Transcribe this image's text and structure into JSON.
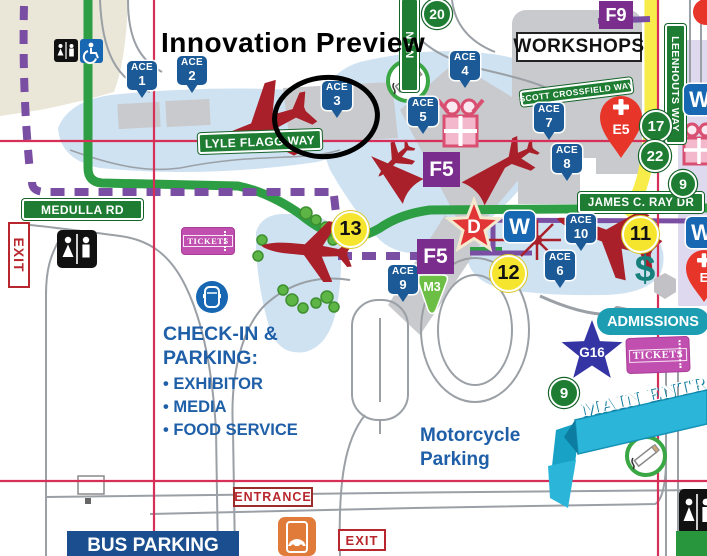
{
  "title": "Innovation Preview",
  "roads": {
    "lyle_flagg": "LYLE FLAGG WAY",
    "medulla": "MEDULLA RD",
    "james_ray": "JAMES C. RAY DR",
    "scott_crossfield": "SCOTT CROSSFIELD WAY",
    "leenhouts": "LEENHOUTS WAY",
    "partial_lane": "N LN"
  },
  "buildings": {
    "workshops": "WORKSHOPS"
  },
  "ace": {
    "label": "ACE",
    "numbers": [
      "1",
      "2",
      "3",
      "4",
      "5",
      "6",
      "7",
      "8",
      "9",
      "10"
    ]
  },
  "zones": {
    "f5": "F5",
    "f9": "F9",
    "m3": "M3",
    "g16": "G16",
    "d_star": "D",
    "e5": "E5",
    "e_partial": "E",
    "water": "W"
  },
  "circle_markers": {
    "n20": "20",
    "n17": "17",
    "n22": "22",
    "n9": "9",
    "y13": "13",
    "y11": "11",
    "y12": "12"
  },
  "signs": {
    "exit": "EXIT",
    "entrance": "ENTRANCE",
    "tickets": "TICKETS",
    "admissions": "ADMISSIONS",
    "main_entrance": "MAIN ENTR",
    "bus_parking": "BUS PARKING"
  },
  "texts": {
    "checkin_line1": "CHECK-IN &",
    "checkin_line2": "PARKING:",
    "checkin_items": [
      "• EXHIBITOR",
      "• MEDIA",
      "• FOOD SERVICE"
    ],
    "motorcycle_line1": "Motorcycle",
    "motorcycle_line2": "Parking",
    "dollar": "$"
  },
  "colors": {
    "grid": "#d63058",
    "route_green": "#2e9e44",
    "route_purple": "#7a4fa3",
    "ace_blue": "#1b5a96",
    "zone_purple": "#7b2d8e",
    "marker_green": "#1e7d33",
    "marker_yellow": "#f5e52e",
    "teal": "#1d9db2",
    "banner_teal": "#2bb5d8",
    "ticket_magenta": "#c14fb0",
    "plane_red": "#a9202a",
    "alert_red": "#e8352a",
    "star_blue": "#3434a4",
    "m3_green": "#6cbe45",
    "road_yellow": "#f7ec49",
    "text_blue": "#1f5fa8",
    "exit_red": "#b8272d",
    "bus_blue": "#1b4e8e",
    "dollar_teal": "#17807a"
  }
}
